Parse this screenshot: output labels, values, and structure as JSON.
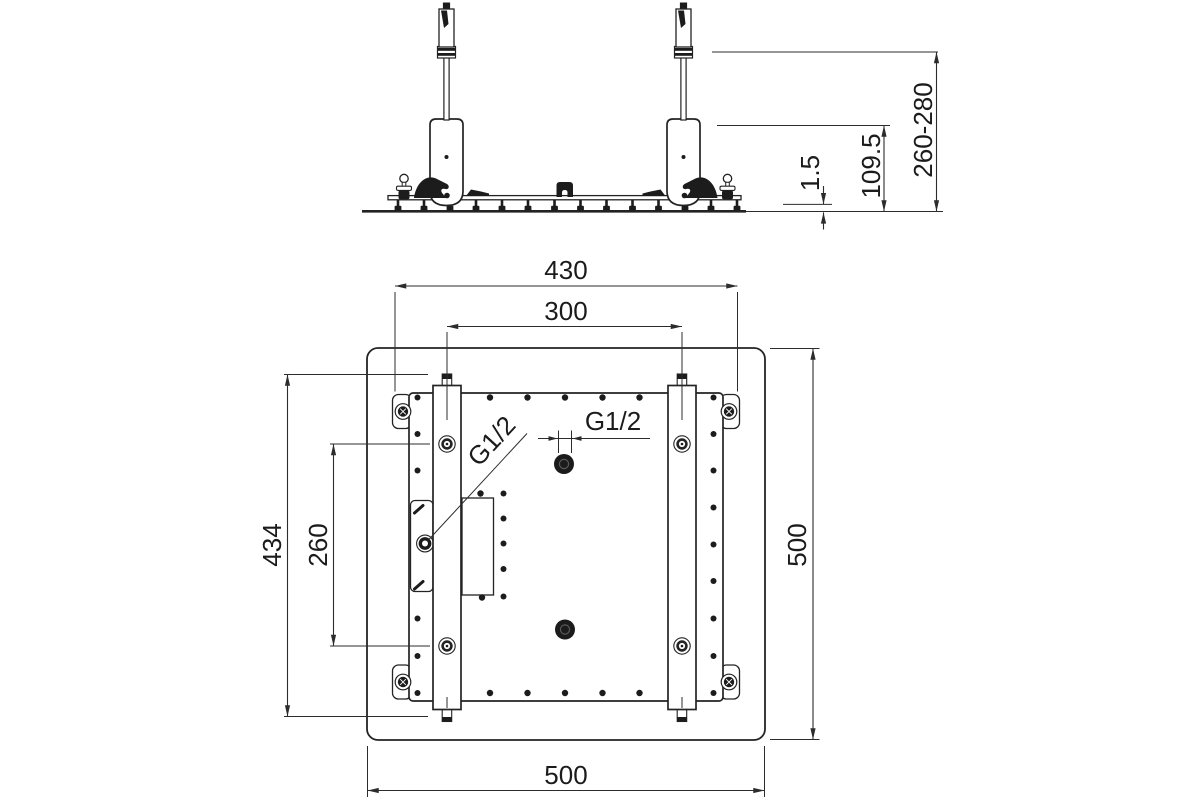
{
  "drawing": {
    "type": "installation-drawing",
    "line_color": "#232323",
    "background": "#ffffff"
  },
  "side_view": {
    "dim_plate_thickness": "1.5",
    "dim_housing_height": "109.5",
    "dim_height_range": "260-280"
  },
  "plan_view": {
    "dim_plate_width": "430",
    "dim_rail_spacing": "300",
    "dim_plate_height": "434",
    "dim_hole_spacing": "260",
    "dim_frame_width": "500",
    "dim_frame_height": "500",
    "thread_side_inlet": "G1/2",
    "thread_top_inlet": "G1/2"
  }
}
